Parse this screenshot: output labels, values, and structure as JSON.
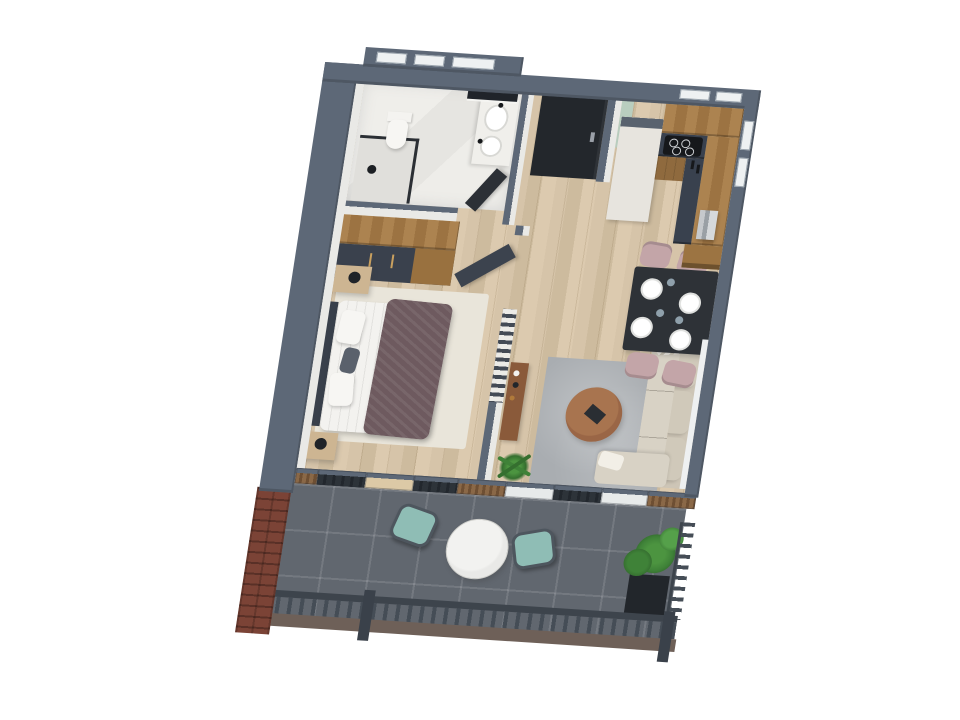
{
  "scene": {
    "description": "3D isometric cut-away render of a one-bedroom apartment floor plan with terrace, viewed from above on a white background, plan tilted slightly clockwise",
    "background": "#ffffff",
    "rooms": [
      {
        "name": "bathroom",
        "position": "top-left",
        "contents": [
          "walk-in shower with black glass frame",
          "toilet",
          "vanity with two basins and black faucets",
          "dark wall mirror",
          "white marble tile"
        ]
      },
      {
        "name": "entry-hall",
        "position": "top-center",
        "contents": [
          "black front door",
          "wood floor"
        ]
      },
      {
        "name": "kitchen",
        "position": "top-right",
        "contents": [
          "L-shaped wood cabinets",
          "dark countertop",
          "black cooktop with four burners",
          "tall white unit",
          "green glass partition",
          "coffee machine",
          "wood shelf"
        ]
      },
      {
        "name": "dining-area",
        "position": "right",
        "contents": [
          "dark rectangular table",
          "four mauve upholstered chairs",
          "four white plates",
          "glasses"
        ]
      },
      {
        "name": "living-room",
        "position": "center-right",
        "contents": [
          "beige L-shaped sofa with cushions",
          "gray area rug",
          "round wood coffee table",
          "laptop",
          "wood sideboard with decor",
          "potted palm"
        ]
      },
      {
        "name": "bedroom",
        "position": "center-left",
        "contents": [
          "double bed with white sheets",
          "mauve blanket",
          "dark headboard",
          "two nightstands with black lamps",
          "wardrobe with dark and wood fronts",
          "light area rug",
          "open dark door",
          "slatted divider screen"
        ]
      },
      {
        "name": "terrace",
        "position": "bottom",
        "contents": [
          "dark gray tile floor",
          "round white table",
          "two teal lounge chairs",
          "green tree in black planter",
          "dark metal railing",
          "red brick corner pillar",
          "sliding glass wall with wood-slat panels"
        ]
      }
    ]
  },
  "palette": {
    "wall_top": "#5d6877",
    "wall_side": "#47505d",
    "wall_white": "#e9e9e6",
    "floor_wood": "#d3c1a6",
    "bath_floor": "#eceae6",
    "terrace_tile": "#61676f",
    "brick": "#7b4336",
    "cab_wood": "#a87e4c",
    "counter_dark": "#39414e",
    "unit_white": "#e7e4de",
    "glass_green": "#b7cfc1",
    "table_dark": "#2e3237",
    "chair_mauve": "#c3a5a8",
    "sofa_beige": "#d8d2c5",
    "sofa_back": "#cdc5b6",
    "rug_gray": "#a9adb1",
    "rug_bed": "#e9e5da",
    "blanket_mauve": "#6e5a5f",
    "bed_white": "#f3f2ef",
    "headboard_dark": "#39404b",
    "nightstand_wood": "#cdb592",
    "door_black": "#23272c",
    "door_gray": "#3c434e",
    "plywood": "#dcc9a6",
    "glass_pane": "#e7eaea",
    "chair_teal": "#8fbdb5",
    "table_white": "#e9e9e7",
    "plant_green": "#3f8238",
    "pot_black": "#22262b",
    "rail_dark": "#454d56",
    "rail_base": "#6e6058",
    "metal_silver": "#c6c9cc",
    "wood_shelf": "#9c7442",
    "sideboard_wood": "#8a5a3a",
    "coffee_table_wood": "#9a6646"
  }
}
